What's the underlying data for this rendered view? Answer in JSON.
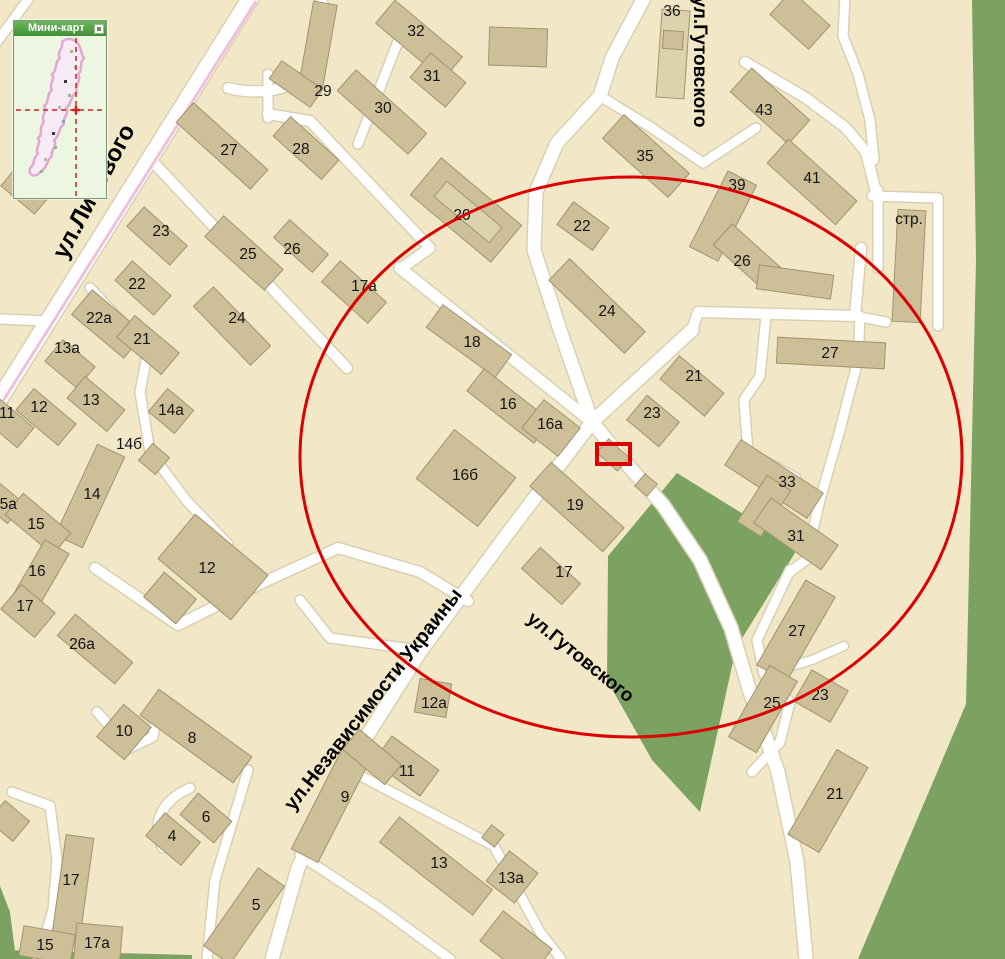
{
  "map": {
    "background": "#F2E8C8",
    "road_fill": "#FFFFFF",
    "road_casing": "#D9D0B3",
    "building_fill": "#CDBF98",
    "building_fill_light": "#DCD2AE",
    "building_stroke": "#A0946E",
    "green_fill": "#7BA261",
    "railway_color": "#EFC0DC",
    "highlight_color": "#DD0000",
    "label_color": "#141414"
  },
  "greens": [
    "677,473 798,548 736,648 700,812 652,760 607,680 608,556",
    "972,0 1005,0 1005,959 858,959 966,704 976,260",
    "0,886 10,912 16,959 0,959",
    "0,950 192,955 192,959 0,959"
  ],
  "roads": [
    {
      "d": "M32,-6 L-6,46",
      "w": 9
    },
    {
      "d": "M253,-6 L0,398",
      "w": 16
    },
    {
      "d": "M322,2 C334,50 315,74 290,85 C268,94 243,92 228,88",
      "w": 10
    },
    {
      "d": "M645,-4 L612,58 L600,96 L557,143 L536,192 L534,250 L560,330 L592,422 L625,462 L663,505 L700,560 L731,628 L750,692 L778,772 L797,862 L806,959",
      "w": 13
    },
    {
      "d": "M692,330 L592,422 L505,537 L420,652 L348,766 L298,868 L272,959",
      "w": 13
    },
    {
      "d": "M400,268 L592,422",
      "w": 11
    },
    {
      "d": "M152,161 L347,368",
      "w": 10
    },
    {
      "d": "M268,74 L268,118",
      "w": 9
    },
    {
      "d": "M268,114 L310,121 L430,248 L403,267",
      "w": 10
    },
    {
      "d": "M404,26 L358,144",
      "w": 9
    },
    {
      "d": "M90,288 L148,350 L140,392 L150,452 L186,500 L228,544",
      "w": 9
    },
    {
      "d": "M0,319 L46,321",
      "w": 9
    },
    {
      "d": "M95,568 L178,625 L262,583 L338,548 L420,572 L468,601",
      "w": 10
    },
    {
      "d": "M97,712 L130,748 L153,737 L159,700",
      "w": 9
    },
    {
      "d": "M190,788 C162,800 150,824 163,848",
      "w": 9
    },
    {
      "d": "M248,770 L215,880 L207,959",
      "w": 9
    },
    {
      "d": "M342,766 L494,846 L512,880 L540,932 L561,959",
      "w": 9
    },
    {
      "d": "M300,855 L380,908 L450,959",
      "w": 9
    },
    {
      "d": "M12,792 L50,806 L57,860 L53,910 L38,959",
      "w": 9
    },
    {
      "d": "M420,650 L330,638 L300,600",
      "w": 9
    },
    {
      "d": "M600,96 L652,128 L703,163 L756,128",
      "w": 9
    },
    {
      "d": "M692,330 L698,312 L855,316 L861,248",
      "w": 10
    },
    {
      "d": "M766,316 L760,376 L744,400 L748,452 L796,478",
      "w": 9
    },
    {
      "d": "M878,190 L878,268",
      "w": 9
    },
    {
      "d": "M872,196 L938,198 L938,326",
      "w": 9
    },
    {
      "d": "M745,62 L806,98 L846,128 L866,152 L876,192",
      "w": 10
    },
    {
      "d": "M845,-4 L843,36 L858,74 L870,120 L874,160",
      "w": 9
    },
    {
      "d": "M860,316 L858,360 L840,430 L820,500 L806,560 L790,572",
      "w": 9
    },
    {
      "d": "M790,570 L757,640 L764,674 L790,702 L780,742 L752,772",
      "w": 9
    },
    {
      "d": "M764,674 L812,660 L844,646",
      "w": 8
    },
    {
      "d": "M855,316 L886,322",
      "w": 9
    }
  ],
  "railway": {
    "d": "M256,1 L3,401",
    "w": 3
  },
  "buildings": [
    {
      "n": "29",
      "x": 318,
      "y": 45,
      "w": 24,
      "h": 85,
      "a": 10,
      "lx": 323,
      "ly": 92
    },
    {
      "n": "",
      "x": 296,
      "y": 84,
      "w": 50,
      "h": 22,
      "a": 35
    },
    {
      "n": "32",
      "x": 419,
      "y": 40,
      "w": 88,
      "h": 30,
      "a": 40,
      "lx": 416,
      "ly": 32
    },
    {
      "n": "31",
      "x": 438,
      "y": 80,
      "w": 46,
      "h": 32,
      "a": 40,
      "lx": 432,
      "ly": 77
    },
    {
      "n": "30",
      "x": 382,
      "y": 112,
      "w": 95,
      "h": 28,
      "a": 42,
      "lx": 383,
      "ly": 109
    },
    {
      "n": "28",
      "x": 306,
      "y": 148,
      "w": 65,
      "h": 26,
      "a": 42,
      "lx": 301,
      "ly": 150
    },
    {
      "n": "27",
      "x": 222,
      "y": 146,
      "w": 100,
      "h": 26,
      "a": 42,
      "lx": 229,
      "ly": 151
    },
    {
      "n": "",
      "x": 26,
      "y": 190,
      "w": 44,
      "h": 26,
      "a": 40
    },
    {
      "n": "23",
      "x": 157,
      "y": 236,
      "w": 58,
      "h": 26,
      "a": 42,
      "lx": 161,
      "ly": 232
    },
    {
      "n": "25",
      "x": 244,
      "y": 253,
      "w": 80,
      "h": 28,
      "a": 42,
      "lx": 248,
      "ly": 255
    },
    {
      "n": "26",
      "x": 301,
      "y": 246,
      "w": 52,
      "h": 24,
      "a": 42,
      "lx": 292,
      "ly": 250
    },
    {
      "n": "22",
      "x": 143,
      "y": 288,
      "w": 52,
      "h": 26,
      "a": 42,
      "lx": 137,
      "ly": 285
    },
    {
      "n": "24",
      "x": 232,
      "y": 326,
      "w": 82,
      "h": 28,
      "a": 46,
      "lx": 237,
      "ly": 319
    },
    {
      "n": "22a",
      "x": 108,
      "y": 324,
      "w": 68,
      "h": 32,
      "a": 40,
      "lx": 99,
      "ly": 319
    },
    {
      "n": "21",
      "x": 148,
      "y": 345,
      "w": 58,
      "h": 28,
      "a": 40,
      "lx": 142,
      "ly": 340
    },
    {
      "n": "13a",
      "x": 70,
      "y": 364,
      "w": 42,
      "h": 28,
      "a": 40,
      "lx": 67,
      "ly": 349
    },
    {
      "n": "12",
      "x": 46,
      "y": 417,
      "w": 55,
      "h": 28,
      "a": 40,
      "lx": 39,
      "ly": 408
    },
    {
      "n": "13",
      "x": 96,
      "y": 404,
      "w": 52,
      "h": 28,
      "a": 40,
      "lx": 91,
      "ly": 401
    },
    {
      "n": "11",
      "x": 8,
      "y": 423,
      "w": 46,
      "h": 26,
      "a": 40,
      "lx": 7,
      "ly": 414
    },
    {
      "n": "14a",
      "x": 171,
      "y": 411,
      "w": 34,
      "h": 30,
      "a": 40
    },
    {
      "n": "14б",
      "x": 154,
      "y": 459,
      "w": 22,
      "h": 22,
      "a": 40,
      "lx": 129,
      "ly": 445
    },
    {
      "n": "14",
      "x": 90,
      "y": 496,
      "w": 30,
      "h": 100,
      "a": 25,
      "lx": 92,
      "ly": 495
    },
    {
      "n": "15a",
      "x": 2,
      "y": 502,
      "w": 36,
      "h": 26,
      "a": 40,
      "lx": 4,
      "ly": 505
    },
    {
      "n": "15",
      "x": 38,
      "y": 524,
      "w": 62,
      "h": 28,
      "a": 40,
      "lx": 36,
      "ly": 525
    },
    {
      "n": "16",
      "x": 39,
      "y": 578,
      "w": 28,
      "h": 72,
      "a": 30,
      "lx": 37,
      "ly": 572
    },
    {
      "n": "17",
      "x": 28,
      "y": 611,
      "w": 44,
      "h": 32,
      "a": 40,
      "lx": 25,
      "ly": 607
    },
    {
      "n": "12",
      "x": 213,
      "y": 567,
      "w": 95,
      "h": 58,
      "a": 40,
      "lx": 207,
      "ly": 569
    },
    {
      "n": "",
      "x": 170,
      "y": 598,
      "w": 42,
      "h": 32,
      "a": 40
    },
    {
      "n": "26a",
      "x": 95,
      "y": 649,
      "w": 75,
      "h": 28,
      "a": 40,
      "lx": 82,
      "ly": 645
    },
    {
      "n": "10",
      "x": 124,
      "y": 732,
      "w": 36,
      "h": 42,
      "a": 40
    },
    {
      "n": "8",
      "x": 196,
      "y": 736,
      "w": 115,
      "h": 32,
      "a": 36,
      "lx": 192,
      "ly": 739
    },
    {
      "n": "6",
      "x": 206,
      "y": 818,
      "w": 44,
      "h": 28,
      "a": 40
    },
    {
      "n": "4",
      "x": 173,
      "y": 839,
      "w": 46,
      "h": 30,
      "a": 40,
      "lx": 172,
      "ly": 837
    },
    {
      "n": "17",
      "x": 73,
      "y": 886,
      "w": 28,
      "h": 100,
      "a": 8,
      "lx": 71,
      "ly": 881
    },
    {
      "n": "15",
      "x": 47,
      "y": 945,
      "w": 52,
      "h": 30,
      "a": 10,
      "lx": 45,
      "ly": 946
    },
    {
      "n": "17a",
      "x": 98,
      "y": 945,
      "w": 46,
      "h": 40,
      "a": 5,
      "lx": 97,
      "ly": 944
    },
    {
      "n": "5",
      "x": 244,
      "y": 916,
      "w": 32,
      "h": 95,
      "a": 35,
      "lx": 256,
      "ly": 906
    },
    {
      "n": "",
      "x": 9,
      "y": 821,
      "w": 32,
      "h": 26,
      "a": 40
    },
    {
      "n": "20",
      "x": 466,
      "y": 210,
      "w": 105,
      "h": 48,
      "a": 40,
      "lx": 462,
      "ly": 216
    },
    {
      "n": "",
      "x": 468,
      "y": 212,
      "w": 72,
      "h": 20,
      "a": 40,
      "light": true
    },
    {
      "n": "17a",
      "x": 354,
      "y": 292,
      "w": 62,
      "h": 28,
      "a": 42,
      "lx": 364,
      "ly": 287
    },
    {
      "n": "18",
      "x": 469,
      "y": 341,
      "w": 85,
      "h": 28,
      "a": 36,
      "lx": 472,
      "ly": 343
    },
    {
      "n": "16",
      "x": 509,
      "y": 406,
      "w": 85,
      "h": 28,
      "a": 38,
      "lx": 508,
      "ly": 405
    },
    {
      "n": "16a",
      "x": 551,
      "y": 428,
      "w": 46,
      "h": 36,
      "a": 38,
      "lx": 550,
      "ly": 425
    },
    {
      "n": "16б",
      "x": 466,
      "y": 478,
      "w": 78,
      "h": 62,
      "a": 38,
      "lx": 465,
      "ly": 476
    },
    {
      "n": "22",
      "x": 583,
      "y": 226,
      "w": 44,
      "h": 28,
      "a": 36,
      "lx": 582,
      "ly": 227
    },
    {
      "n": "24",
      "x": 597,
      "y": 306,
      "w": 105,
      "h": 30,
      "a": 44,
      "lx": 607,
      "ly": 312
    },
    {
      "n": "35",
      "x": 646,
      "y": 156,
      "w": 88,
      "h": 32,
      "a": 42,
      "lx": 645,
      "ly": 157
    },
    {
      "n": "36",
      "x": 673,
      "y": 54,
      "w": 28,
      "h": 88,
      "a": 4,
      "lx": 672,
      "ly": 12,
      "light": true
    },
    {
      "n": "",
      "x": 673,
      "y": 40,
      "w": 20,
      "h": 18,
      "a": 4
    },
    {
      "n": "39",
      "x": 723,
      "y": 216,
      "w": 32,
      "h": 85,
      "a": 27,
      "lx": 737,
      "ly": 186
    },
    {
      "n": "43",
      "x": 770,
      "y": 106,
      "w": 78,
      "h": 32,
      "a": 42,
      "lx": 764,
      "ly": 111
    },
    {
      "n": "41",
      "x": 812,
      "y": 182,
      "w": 92,
      "h": 32,
      "a": 42,
      "lx": 812,
      "ly": 179
    },
    {
      "n": "26",
      "x": 748,
      "y": 257,
      "w": 68,
      "h": 28,
      "a": 42,
      "lx": 742,
      "ly": 262
    },
    {
      "n": "",
      "x": 795,
      "y": 282,
      "w": 75,
      "h": 24,
      "a": 8
    },
    {
      "n": "стр.",
      "x": 909,
      "y": 266,
      "w": 28,
      "h": 112,
      "a": 3,
      "lx": 909,
      "ly": 220
    },
    {
      "n": "23",
      "x": 653,
      "y": 421,
      "w": 42,
      "h": 32,
      "a": 40,
      "lx": 652,
      "ly": 414
    },
    {
      "n": "21",
      "x": 692,
      "y": 386,
      "w": 58,
      "h": 30,
      "a": 40,
      "lx": 694,
      "ly": 377
    },
    {
      "n": "19",
      "x": 577,
      "y": 507,
      "w": 98,
      "h": 32,
      "a": 42,
      "lx": 575,
      "ly": 506
    },
    {
      "n": "",
      "x": 613,
      "y": 455,
      "w": 28,
      "h": 18,
      "a": 42
    },
    {
      "n": "",
      "x": 646,
      "y": 485,
      "w": 16,
      "h": 16,
      "a": 40
    },
    {
      "n": "17",
      "x": 551,
      "y": 576,
      "w": 54,
      "h": 28,
      "a": 42,
      "lx": 564,
      "ly": 573
    },
    {
      "n": "12a",
      "x": 433,
      "y": 698,
      "w": 32,
      "h": 34,
      "a": 10,
      "lx": 434,
      "ly": 704
    },
    {
      "n": "11",
      "x": 406,
      "y": 766,
      "w": 58,
      "h": 32,
      "a": 36,
      "lx": 407,
      "ly": 772
    },
    {
      "n": "9",
      "x": 333,
      "y": 800,
      "w": 30,
      "h": 125,
      "a": 27,
      "lx": 345,
      "ly": 798
    },
    {
      "n": "",
      "x": 372,
      "y": 757,
      "w": 55,
      "h": 26,
      "a": 40
    },
    {
      "n": "13",
      "x": 436,
      "y": 866,
      "w": 118,
      "h": 32,
      "a": 38,
      "lx": 439,
      "ly": 864
    },
    {
      "n": "13a",
      "x": 512,
      "y": 877,
      "w": 36,
      "h": 38,
      "a": 38,
      "lx": 511,
      "ly": 879
    },
    {
      "n": "",
      "x": 493,
      "y": 836,
      "w": 16,
      "h": 16,
      "a": 38
    },
    {
      "n": "",
      "x": 516,
      "y": 945,
      "w": 62,
      "h": 38,
      "a": 38
    },
    {
      "n": "27",
      "x": 796,
      "y": 631,
      "w": 34,
      "h": 98,
      "a": 30,
      "lx": 797,
      "ly": 632
    },
    {
      "n": "25",
      "x": 763,
      "y": 709,
      "w": 32,
      "h": 82,
      "a": 30,
      "lx": 772,
      "ly": 704
    },
    {
      "n": "23",
      "x": 821,
      "y": 696,
      "w": 42,
      "h": 36,
      "a": 30,
      "lx": 820,
      "ly": 696
    },
    {
      "n": "21",
      "x": 828,
      "y": 801,
      "w": 36,
      "h": 98,
      "a": 30,
      "lx": 835,
      "ly": 795
    },
    {
      "n": "33",
      "x": 774,
      "y": 479,
      "w": 98,
      "h": 30,
      "a": 33,
      "lx": 787,
      "ly": 483
    },
    {
      "n": "",
      "x": 764,
      "y": 506,
      "w": 28,
      "h": 55,
      "a": 33
    },
    {
      "n": "31",
      "x": 796,
      "y": 534,
      "w": 82,
      "h": 30,
      "a": 35,
      "lx": 796,
      "ly": 537
    },
    {
      "n": "27",
      "x": 831,
      "y": 353,
      "w": 108,
      "h": 26,
      "a": 3,
      "lx": 830,
      "ly": 354
    },
    {
      "n": "",
      "x": 518,
      "y": 47,
      "w": 58,
      "h": 38,
      "a": 2
    },
    {
      "n": "",
      "x": 800,
      "y": 20,
      "w": 52,
      "h": 32,
      "a": 42
    }
  ],
  "street_labels": [
    {
      "text": "ул.Лисового",
      "x": 95,
      "y": 192,
      "angle": -62,
      "size": 24
    },
    {
      "text": "ул.Гутовского",
      "x": 699,
      "y": 62,
      "angle": 90,
      "size": 19
    },
    {
      "text": "ул.Независимости Украины",
      "x": 374,
      "y": 700,
      "angle": -52,
      "size": 20
    },
    {
      "text": "ул.Гутовского",
      "x": 580,
      "y": 658,
      "angle": 39,
      "size": 19
    }
  ],
  "overlay": {
    "ellipse": {
      "cx": 631,
      "cy": 457,
      "rx": 331,
      "ry": 280,
      "stroke_width": 3
    },
    "marker_rect": {
      "x": 597,
      "y": 444,
      "w": 33,
      "h": 20,
      "stroke_width": 4
    }
  },
  "minimap": {
    "title": "Мини-карт",
    "x": 13,
    "y": 20,
    "w": 94,
    "header_h": 15,
    "body_h": 162,
    "body_color": "#edf6e1",
    "blob_stroke": "#e3a7d2",
    "blob_fill": "#f7ecf5",
    "cross_color": "#cc2222",
    "cross_x": 62,
    "cross_y": 74,
    "blob_path": "M62,6 C68,10 66,18 70,22 C64,28 70,34 64,38 C68,44 60,50 63,56 C56,60 58,68 52,72 C56,78 48,82 50,88 C44,92 46,100 40,104 C44,110 36,114 38,120 C32,124 34,132 26,136 C22,142 14,140 16,132 C22,128 18,122 24,118 C20,112 28,108 24,102 C30,98 24,92 30,86 C26,80 34,76 30,70 C36,66 32,58 38,54 C34,48 42,44 38,38 C44,34 40,26 46,22 C42,16 50,12 48,6 C52,2 58,2 62,6 Z",
    "specks": [
      [
        56,
        14,
        "#9ab586"
      ],
      [
        60,
        30,
        "#b9b6a8"
      ],
      [
        50,
        44,
        "#3a3a3a"
      ],
      [
        54,
        58,
        "#9ab586"
      ],
      [
        44,
        70,
        "#b9b6a8"
      ],
      [
        48,
        84,
        "#8aa0c0"
      ],
      [
        38,
        96,
        "#3a3a3a"
      ],
      [
        40,
        110,
        "#9ab586"
      ],
      [
        30,
        122,
        "#b9b6a8"
      ],
      [
        26,
        134,
        "#9ab586"
      ]
    ]
  }
}
